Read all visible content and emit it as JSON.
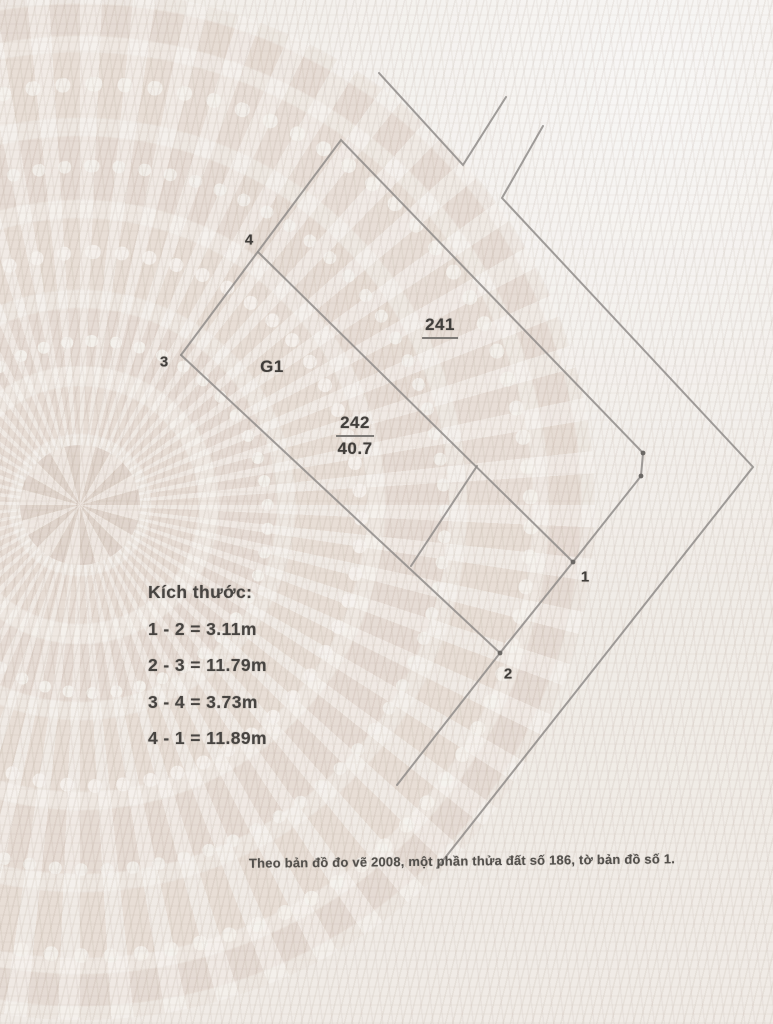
{
  "labels": {
    "point1": "1",
    "point2": "2",
    "point3": "3",
    "point4": "4",
    "adjacent_parcel": "241",
    "parcel_number": "242",
    "parcel_area": "40.7",
    "parcel_code": "G1"
  },
  "dimensions": {
    "title": "Kích thước:",
    "items": [
      "1 - 2 = 3.11m",
      "2 - 3 = 11.79m",
      "3 - 4 = 3.73m",
      "4 - 1 = 11.89m"
    ]
  },
  "footnote": "Theo bản đồ đo vẽ 2008, một phần thửa đất số 186, tờ bản đồ số 1.",
  "colors": {
    "paper": "#f1ede8",
    "boundary_line": "#8f8c89",
    "text": "#413e3b",
    "watermark": "#e7dcd4"
  },
  "diagram": {
    "polylines": [
      {
        "name": "detached-corner-v",
        "points": [
          [
            379,
            73
          ],
          [
            463,
            165
          ],
          [
            506,
            97
          ]
        ]
      },
      {
        "name": "outer-boundary-zigzag",
        "points": [
          [
            543,
            126
          ],
          [
            502,
            198
          ],
          [
            753,
            467
          ],
          [
            437,
            868
          ]
        ]
      },
      {
        "name": "edge-3-4-extended-to-241",
        "points": [
          [
            181,
            355
          ],
          [
            341,
            140
          ],
          [
            643,
            453
          ]
        ]
      },
      {
        "name": "corner-jog-to-point-1",
        "points": [
          [
            643,
            453
          ],
          [
            641,
            476
          ],
          [
            573,
            562
          ]
        ]
      },
      {
        "name": "edge-4-1",
        "points": [
          [
            258,
            252
          ],
          [
            573,
            562
          ]
        ]
      },
      {
        "name": "edge-1-2-extended",
        "points": [
          [
            573,
            562
          ],
          [
            500,
            653
          ],
          [
            397,
            785
          ]
        ]
      },
      {
        "name": "edge-3-2",
        "points": [
          [
            181,
            355
          ],
          [
            500,
            653
          ]
        ]
      },
      {
        "name": "inner-division-line",
        "points": [
          [
            477,
            466
          ],
          [
            411,
            566
          ]
        ]
      }
    ],
    "dots": [
      [
        573,
        562
      ],
      [
        500,
        653
      ],
      [
        643,
        453
      ],
      [
        641,
        476
      ]
    ]
  }
}
